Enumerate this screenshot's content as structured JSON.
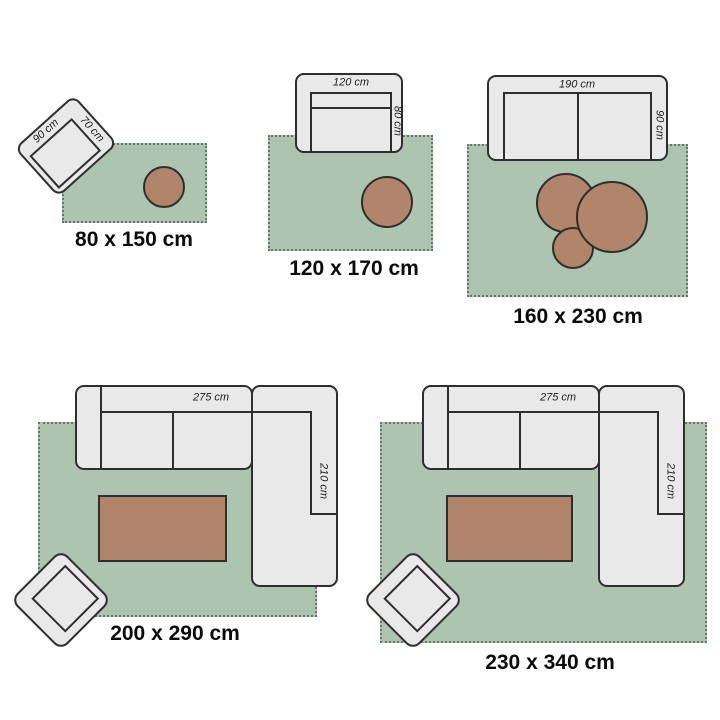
{
  "colors": {
    "bg": "#ffffff",
    "rug": "#adc5b0",
    "rug-edge": "#66766a",
    "furniture": "#e9e9e9",
    "outline": "#2e2e2e",
    "table": "#b1856c",
    "dim": "#1c1c1c",
    "label": "#0a0a0a"
  },
  "groups": [
    {
      "size_label": "80 x 150 cm",
      "furniture_width_label": "90 cm",
      "furniture_depth_label": "70 cm"
    },
    {
      "size_label": "120 x 170 cm",
      "furniture_width_label": "120 cm",
      "furniture_depth_label": "80 cm"
    },
    {
      "size_label": "160 x 230 cm",
      "furniture_width_label": "190 cm",
      "furniture_depth_label": "90 cm"
    },
    {
      "size_label": "200 x 290 cm",
      "furniture_width_label": "275 cm",
      "furniture_depth_label": "210 cm"
    },
    {
      "size_label": "230 x 340 cm",
      "furniture_width_label": "275 cm",
      "furniture_depth_label": "210 cm"
    }
  ]
}
